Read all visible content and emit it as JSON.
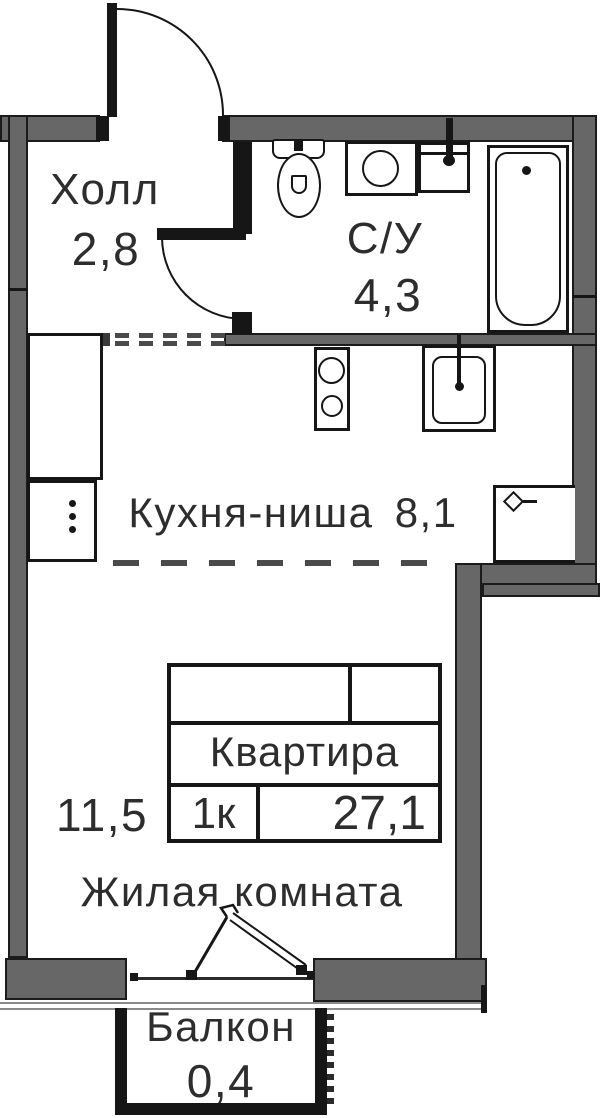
{
  "plan": {
    "rooms": {
      "hall": {
        "name": "Холл",
        "area": "2,8"
      },
      "bathroom": {
        "name": "С/У",
        "area": "4,3"
      },
      "kitchen": {
        "name": "Кухня-ниша",
        "area": "8,1"
      },
      "living": {
        "name": "Жилая комната",
        "area": "11,5"
      },
      "balcony": {
        "name": "Балкон",
        "area": "0,4"
      }
    },
    "info_table": {
      "title": "Квартира",
      "rooms_count": "1к",
      "total_area": "27,1"
    },
    "fixtures": [
      "toilet",
      "washing-machine",
      "bathroom-sink",
      "bathtub",
      "stove",
      "kitchen-sink",
      "wardrobe",
      "refrigerator",
      "vent-shaft",
      "entrance-door",
      "bathroom-door",
      "balcony-door",
      "window"
    ],
    "colors": {
      "wall_gray": "#676767",
      "line_black": "#161616",
      "text": "#2d2d2d",
      "background": "#ffffff"
    }
  }
}
